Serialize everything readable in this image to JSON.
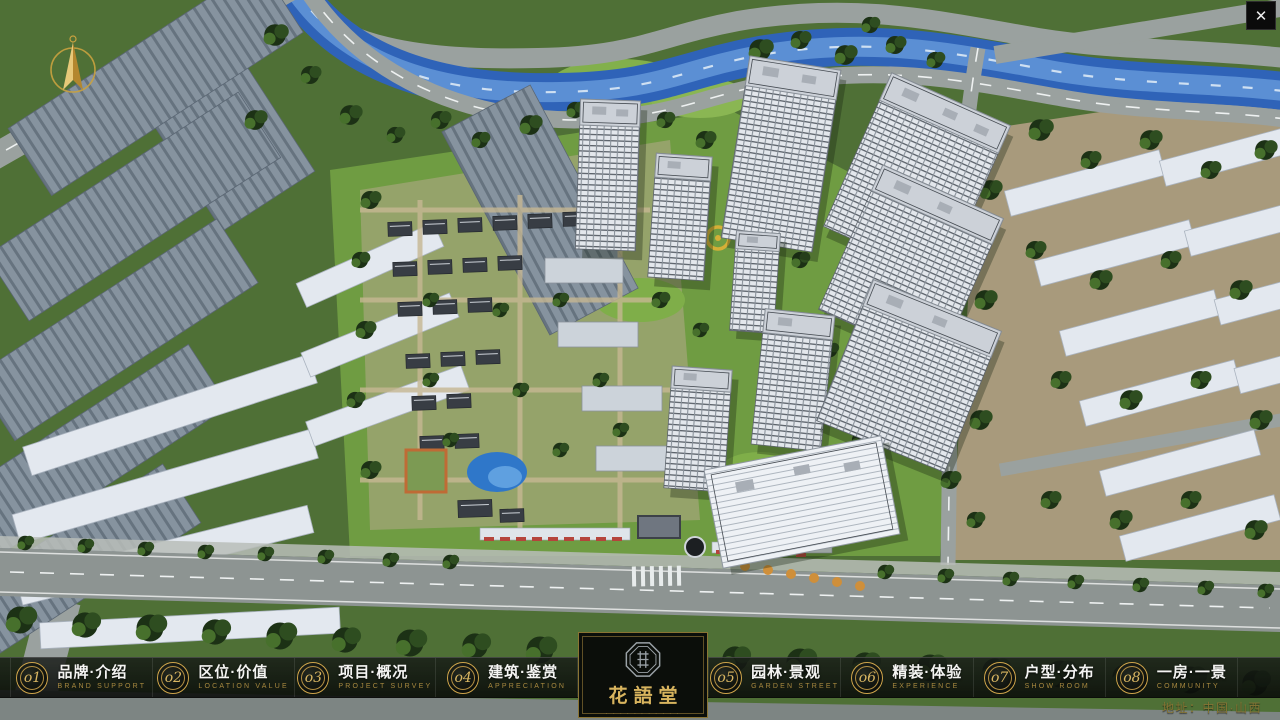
{
  "window": {
    "close_glyph": "✕"
  },
  "logo": {
    "title": "花語堂",
    "tagline": "· · · · · · · · · · ·"
  },
  "menu": {
    "items": [
      {
        "num": "o1",
        "zh": "品牌·介绍",
        "en": "BRAND SUPPORT"
      },
      {
        "num": "o2",
        "zh": "区位·价值",
        "en": "LOCATION VALUE"
      },
      {
        "num": "o3",
        "zh": "项目·概况",
        "en": "PROJECT SURVEY"
      },
      {
        "num": "o4",
        "zh": "建筑·鉴赏",
        "en": "APPRECIATION"
      },
      {
        "num": "o5",
        "zh": "园林·景观",
        "en": "GARDEN STREET"
      },
      {
        "num": "o6",
        "zh": "精装·体验",
        "en": "EXPERIENCE"
      },
      {
        "num": "o7",
        "zh": "户型·分布",
        "en": "SHOW ROOM"
      },
      {
        "num": "o8",
        "zh": "一房·一景",
        "en": "COMMUNITY"
      }
    ]
  },
  "footer": {
    "address": "地址：中国·山西"
  },
  "colors": {
    "gold": "#cfa54b",
    "bar_bg": "#0c100d",
    "river": "#2f63b8",
    "lawn": "#6f9c42"
  }
}
